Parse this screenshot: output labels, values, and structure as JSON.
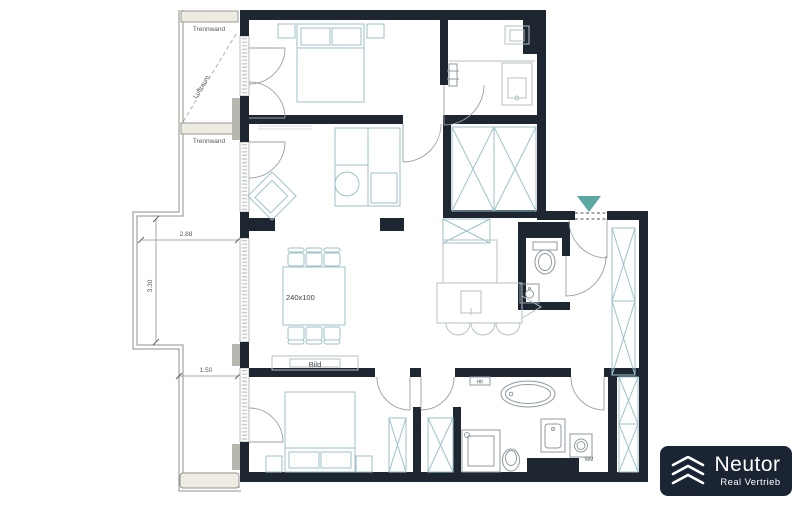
{
  "plan": {
    "balcony": {
      "partition_top_label": "Trennwand",
      "partition_mid_label": "Trennwand",
      "airspace_label": "Luftraum",
      "dim_width": "2.88",
      "dim_depth": "3.30",
      "dim_lower": "1.50"
    },
    "living_room": {
      "dining_table_label": "240x100",
      "sideboard_label": "Bild"
    },
    "bathroom": {
      "radiator_label": "HK",
      "washing_machine_label": "WM"
    },
    "colors": {
      "wall": "#1d2631",
      "furniture_outline": "#9cc2ca",
      "fixture_outline": "#8f9aa0",
      "door_arc": "#98a0a5",
      "entrance_marker": "#5ba7a1",
      "balcony_outline": "#8f8f89",
      "dimension_text": "#555b60",
      "logo_background": "#1b2433",
      "logo_text": "#ffffff"
    }
  },
  "logo": {
    "title": "Neutor",
    "subtitle": "Real Vertrieb"
  }
}
